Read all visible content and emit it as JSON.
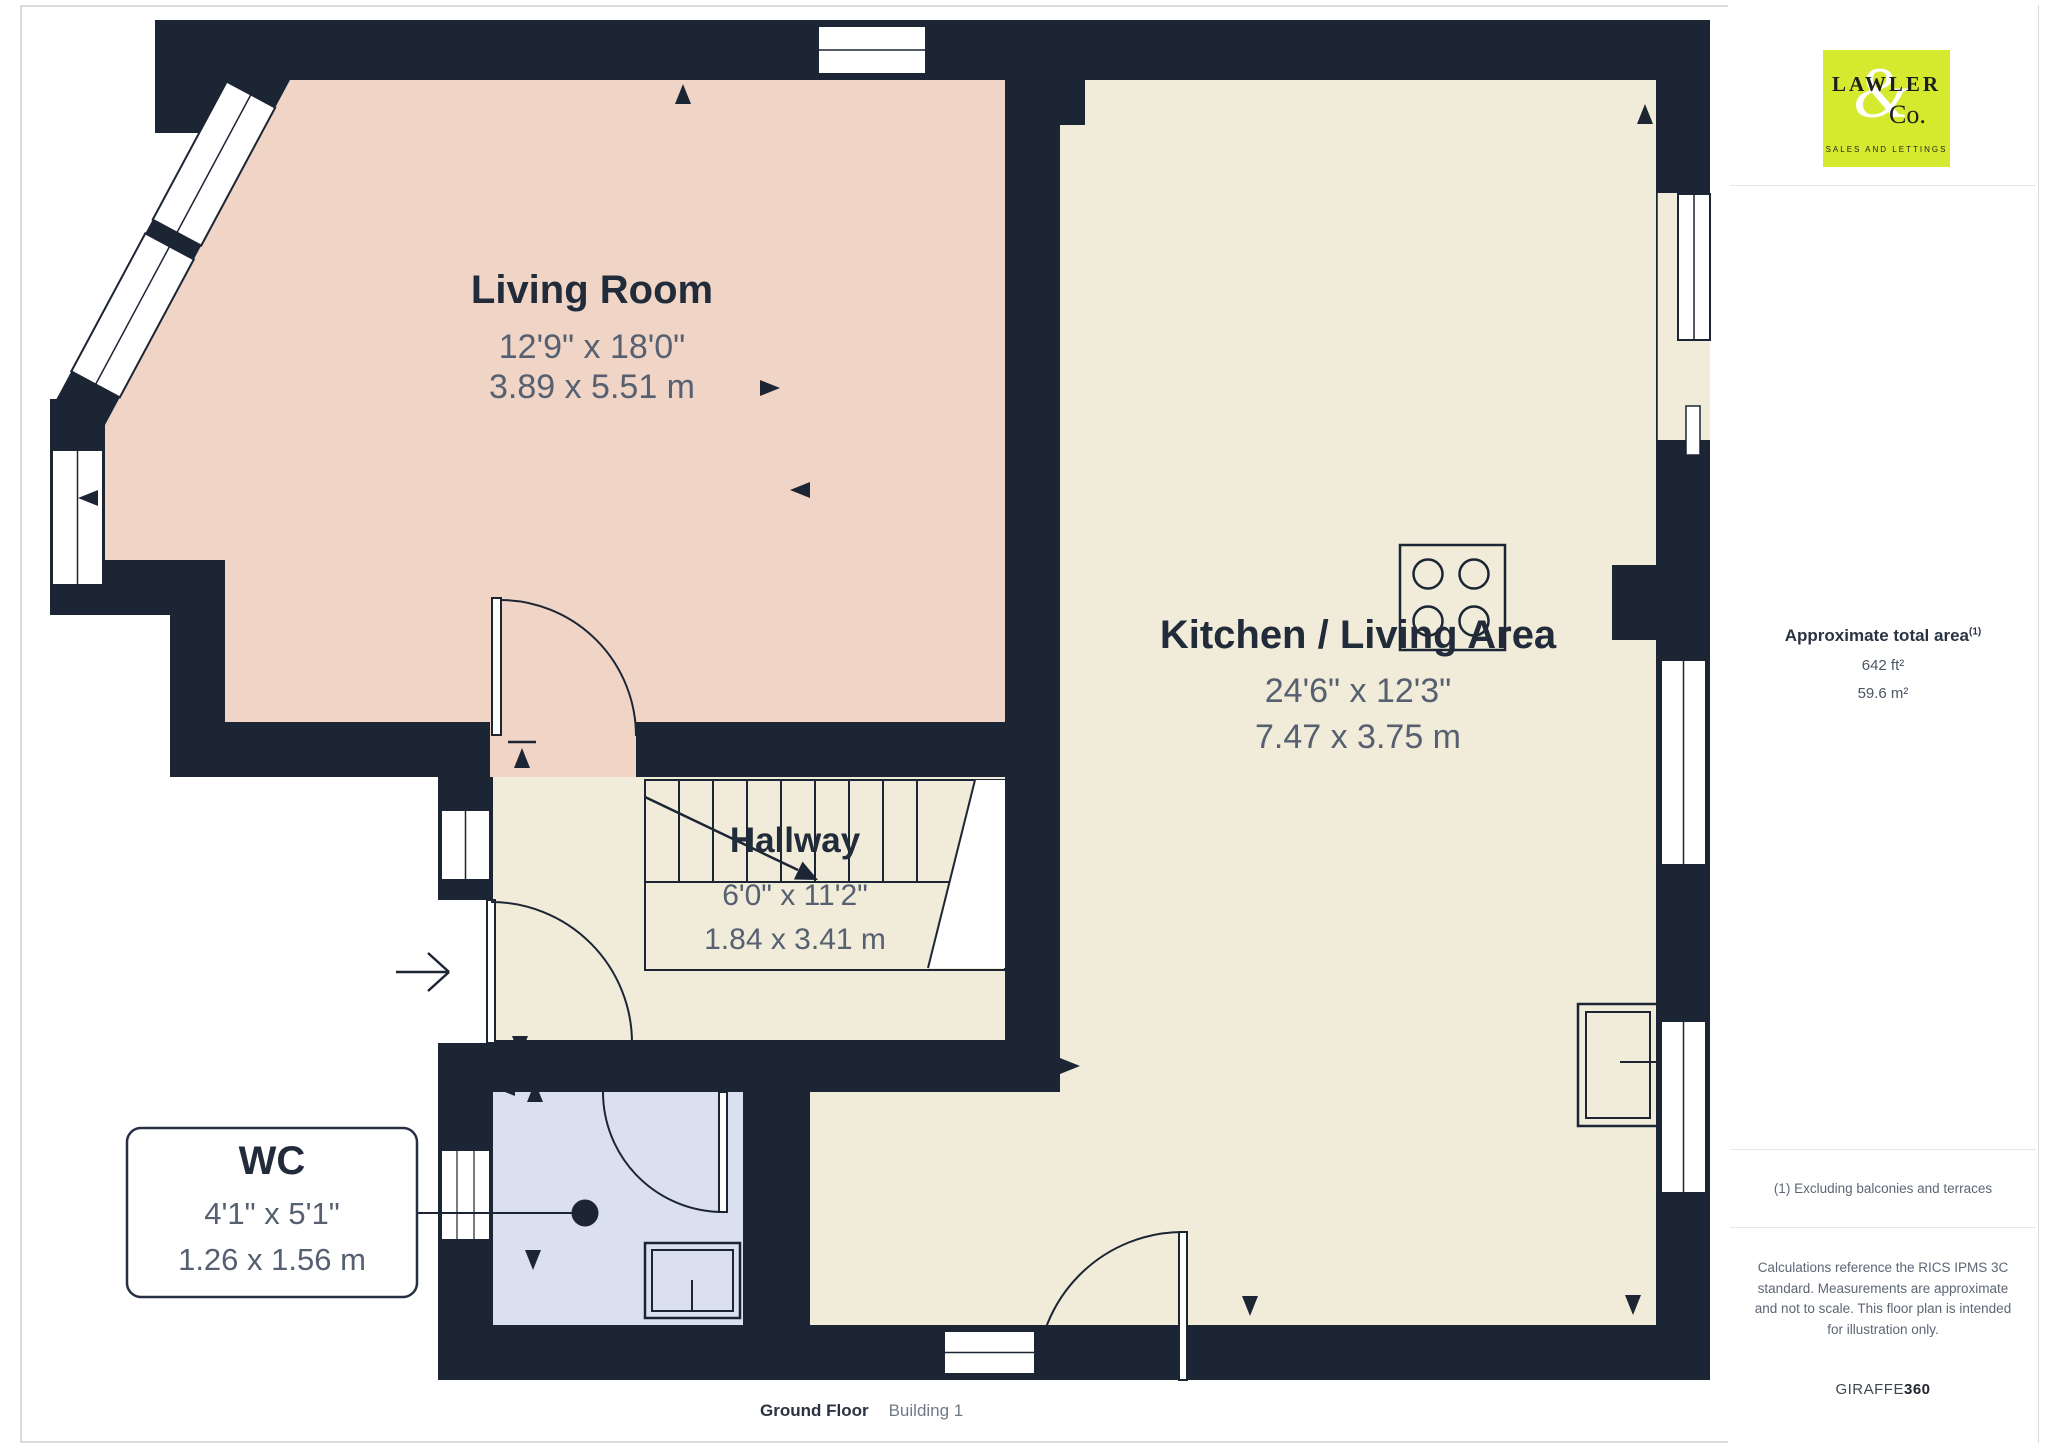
{
  "floorplan": {
    "rooms": {
      "living_room": {
        "name": "Living Room",
        "dims_imperial": "12'9\" x 18'0\"",
        "dims_metric": "3.89 x 5.51 m"
      },
      "kitchen": {
        "name": "Kitchen / Living Area",
        "dims_imperial": "24'6\" x 12'3\"",
        "dims_metric": "7.47 x 3.75 m"
      },
      "hallway": {
        "name": "Hallway",
        "dims_imperial": "6'0\" x 11'2\"",
        "dims_metric": "1.84 x 3.41 m"
      },
      "wc": {
        "name": "WC",
        "dims_imperial": "4'1\" x 5'1\"",
        "dims_metric": "1.26 x 1.56 m"
      }
    },
    "colors": {
      "wall": "#1c2534",
      "living_room_floor": "#f0d5c7",
      "kitchen_floor": "#f0ecd9",
      "wc_floor": "#dbe0ee",
      "logo_background": "#d5e92e"
    },
    "icons": [
      "staircase-icon",
      "hob-icon",
      "toilet-icon",
      "sink-icon",
      "entrance-arrow-icon",
      "door-swing",
      "window",
      "measure-arrow"
    ]
  },
  "sidebar": {
    "logo": {
      "line1": "LAWLER",
      "ampersand": "&",
      "line2": "Co.",
      "tagline": "SALES AND LETTINGS"
    },
    "area_title": "Approximate total area",
    "area_superscript": "(1)",
    "area_imperial": "642 ft²",
    "area_metric": "59.6 m²",
    "footnote": "(1) Excluding balconies and terraces",
    "disclaimer": "Calculations reference the RICS IPMS 3C standard. Measurements are approximate and not to scale. This floor plan is intended for illustration only.",
    "brand_regular": "GIRAFFE",
    "brand_bold": "360"
  },
  "footer": {
    "floor_label": "Ground Floor",
    "building_label": "Building 1"
  }
}
